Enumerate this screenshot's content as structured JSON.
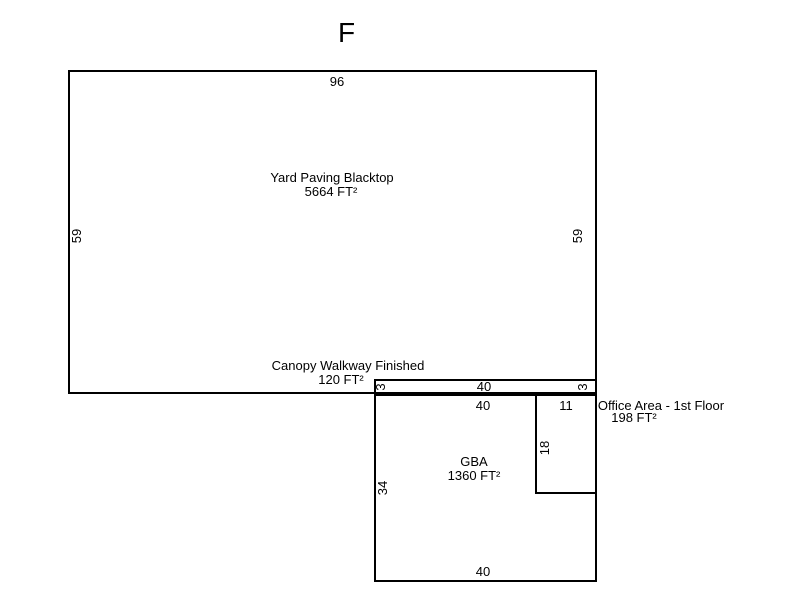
{
  "title": "F",
  "colors": {
    "line": "#000000",
    "background": "#ffffff",
    "text": "#000000"
  },
  "regions": {
    "yard": {
      "label": "Yard Paving Blacktop",
      "area": "5664 FT²",
      "dims": {
        "top": "96",
        "left": "59",
        "right": "59"
      }
    },
    "canopy": {
      "label": "Canopy Walkway Finished",
      "area": "120 FT²",
      "dims": {
        "left": "3",
        "top": "40",
        "right": "3"
      }
    },
    "gba": {
      "label": "GBA",
      "area": "1360 FT²",
      "dims": {
        "top": "40",
        "left": "34",
        "bottom": "40"
      }
    },
    "office": {
      "label": "Office Area - 1st Floor",
      "area": "198 FT²",
      "dims": {
        "top": "11",
        "side": "18"
      }
    }
  }
}
